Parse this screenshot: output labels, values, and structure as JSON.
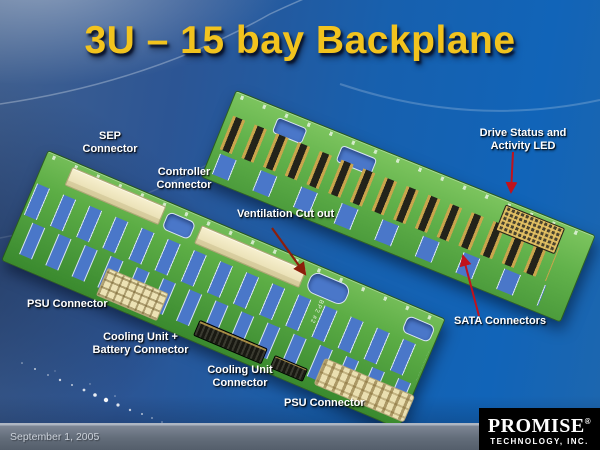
{
  "slide": {
    "title": "3U – 15 bay Backplane",
    "footer_date": "September 1, 2005"
  },
  "logo": {
    "brand": "PROMISE",
    "registered": "®",
    "subtitle": "TECHNOLOGY, INC."
  },
  "callouts": {
    "sep": {
      "line1": "SEP",
      "line2": "Connector"
    },
    "controller": {
      "line1": "Controller",
      "line2": "Connector"
    },
    "ventilation": {
      "text": "Ventilation Cut out"
    },
    "drive_led": {
      "line1": "Drive Status and",
      "line2": "Activity LED"
    },
    "psu_left": {
      "text": "PSU Connector"
    },
    "cooling_battery": {
      "line1": "Cooling Unit +",
      "line2": "Battery Connector"
    },
    "cooling_unit": {
      "line1": "Cooling Unit",
      "line2": "Connector"
    },
    "psu_bottom": {
      "text": "PSU Connector"
    },
    "sata": {
      "text": "SATA Connectors"
    }
  },
  "boards": {
    "front_silkscreen": "BP2 #2"
  },
  "colors": {
    "title_gold": "#F2C31E",
    "background_blue": "#1164B8",
    "pcb_green": "#5CAD45",
    "cutout_blue": "#4A77C9",
    "connector_cream": "#EDE4B8",
    "arrow_red": "#C1121C",
    "arrow_dark_red": "#8C1E0A",
    "footer_bar_gray": "#636D7A",
    "logo_background": "#000000"
  }
}
